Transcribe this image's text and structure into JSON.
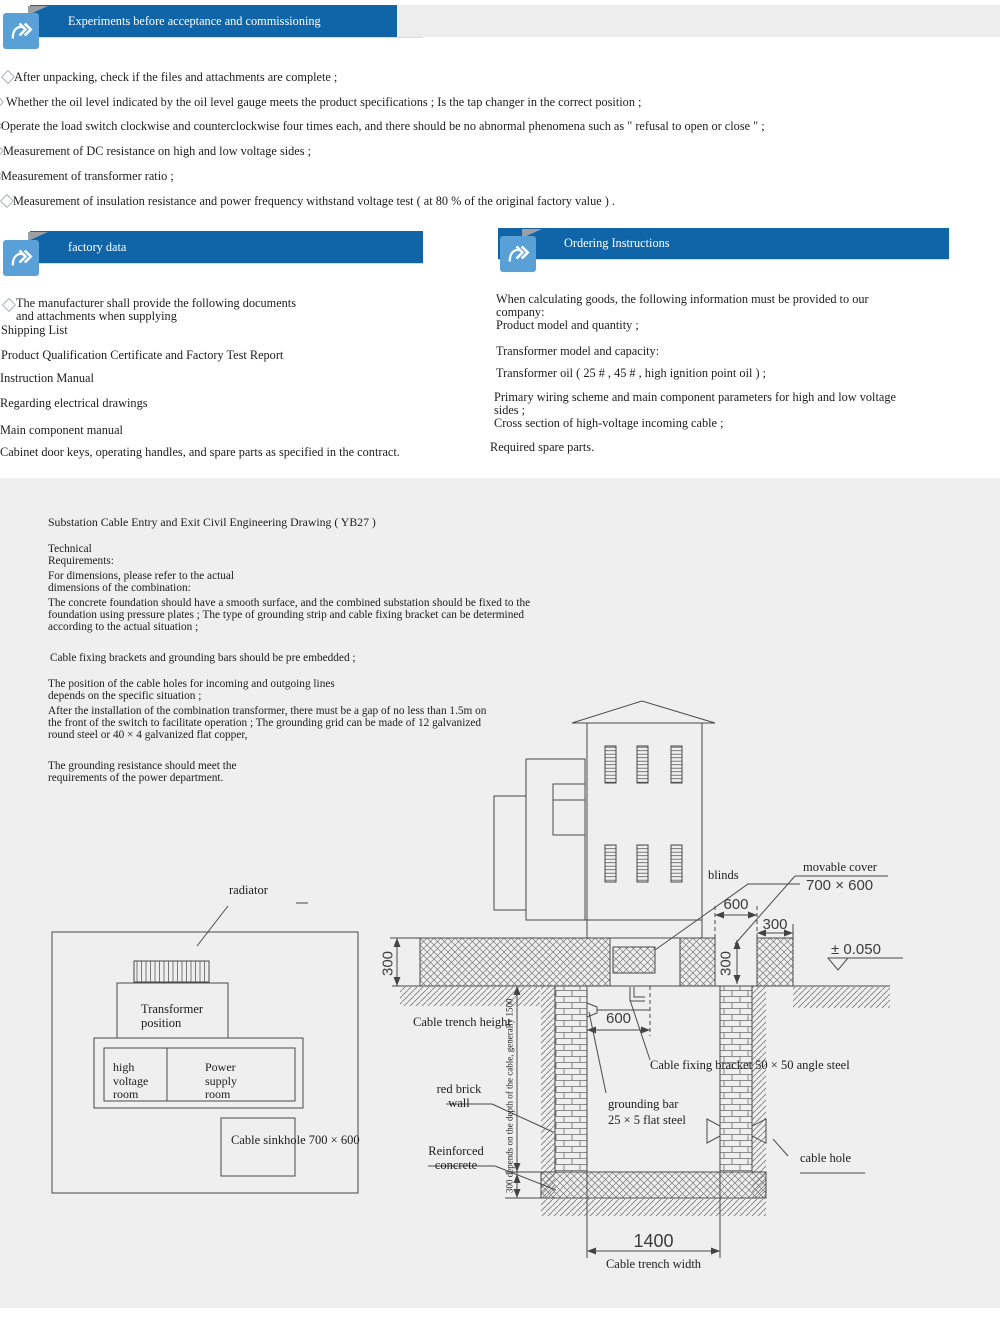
{
  "banners": {
    "experiments": "Experiments before acceptance and commissioning",
    "factory": "factory data",
    "ordering": "Ordering Instructions"
  },
  "experiments_list": [
    "After unpacking, check if the files and attachments are complete ;",
    "Whether the oil level indicated by the oil level gauge meets the product specifications ; Is the tap changer in the correct position ;",
    "Operate the load switch clockwise and counterclockwise four times each, and there should be no abnormal phenomena such as \" refusal to open or close \" ;",
    "Measurement of DC resistance on high and low voltage sides ;",
    "Measurement of transformer ratio ;",
    "Measurement of insulation resistance and power frequency withstand voltage test ( at 80 % of the original factory value ) ."
  ],
  "factory_list": {
    "intro": "The manufacturer shall provide the following documents\nand attachments when supplying",
    "items": [
      "Shipping List",
      "Product Qualification Certificate and Factory Test Report",
      "Instruction Manual",
      "Regarding electrical drawings",
      "Main component manual",
      "Cabinet door keys, operating handles, and spare parts as specified in the contract."
    ]
  },
  "ordering_list": [
    "When calculating goods, the following information must be provided to our\ncompany:\nProduct model and quantity ;",
    "Transformer model and capacity:",
    "Transformer oil ( 25 # , 45 # , high ignition point oil ) ;",
    "Primary wiring scheme and main component parameters for high and low voltage\nsides ;\nCross section of high-voltage incoming cable ;",
    "Required spare parts."
  ],
  "drawing": {
    "title": "Substation Cable Entry and Exit Civil Engineering Drawing ( YB27 )",
    "tech_requirements": "Technical\nRequirements:",
    "paragraphs": [
      "For dimensions, please refer to the actual\ndimensions of the combination:",
      "The concrete foundation should have a smooth surface, and the combined substation should be fixed to the\nfoundation using pressure plates ; The type of grounding strip and cable fixing bracket can be determined\naccording to the actual situation ;",
      "Cable fixing brackets and grounding bars should be pre embedded ;",
      "The position of the cable holes for incoming and outgoing lines\ndepends on the specific situation ;",
      "After the installation of the combination transformer, there must be a gap of no less than 1.5m on\nthe front of the switch to facilitate operation ; The grounding grid can be made of 12 galvanized\nround steel or 40 × 4 galvanized flat copper,",
      "The grounding resistance should meet the\nrequirements of the power department."
    ],
    "plan": {
      "radiator": "radiator",
      "transformer_position": "Transformer\nposition",
      "high_voltage_room": "high\nvoltage\nroom",
      "power_supply_room": "Power\nsupply\nroom",
      "cable_sinkhole": "Cable sinkhole 700 × 600"
    },
    "labels": {
      "blinds": "blinds",
      "movable_cover": "movable cover",
      "movable_cover_size": "700 × 600",
      "cable_trench_height": "Cable trench height",
      "red_brick_wall": "red brick\nwall",
      "reinforced_concrete": "Reinforced\nconcrete",
      "grounding_bar": "grounding bar\n25 × 5 flat steel",
      "cable_fixing_bracket": "Cable fixing bracket 50 × 50 angle steel",
      "cable_hole": "cable hole",
      "depth_note": "300 depends on the depth of the cable, generally 1500",
      "trench_width": "Cable trench width"
    },
    "dims": {
      "slab_height": "300",
      "cover_opening": "600",
      "slab_edge": "300",
      "cover_depth": "300",
      "level": "± 0.050",
      "inner_span": "600",
      "trench_width": "1400"
    }
  }
}
